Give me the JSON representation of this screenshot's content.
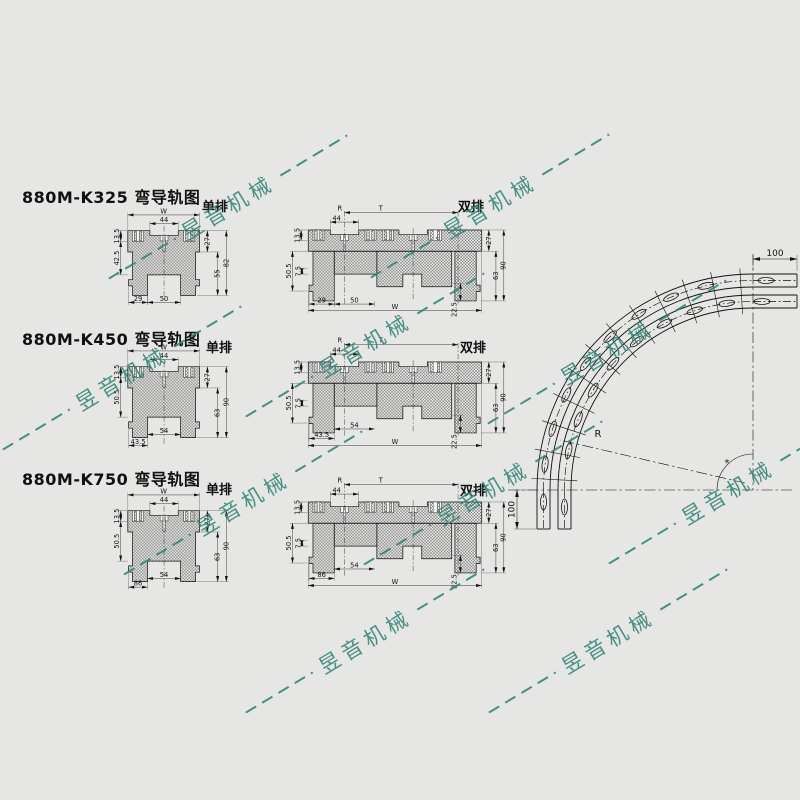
{
  "page": {
    "background": "#e6e6e4",
    "line_color": "#111111"
  },
  "watermark": {
    "text": "昱音机械",
    "color": "#2f8577"
  },
  "sections": [
    {
      "title": "880M-K325 弯导轨图",
      "single_label": "单排",
      "double_label": "双排",
      "single": {
        "w": "W",
        "n44": "44",
        "h135": "13.5",
        "left": "42.5",
        "r1": "27",
        "r2": "55",
        "r3": "82",
        "b1": "29",
        "b2": "50"
      },
      "double": {
        "n44": "44",
        "r": "R",
        "t": "T",
        "h135": "13.5",
        "l1": "50.5",
        "l2": "7.5",
        "r1": "27",
        "r2": "90",
        "r3": "63",
        "r4": "22.5",
        "b1": "29",
        "b2": "50",
        "w": "W"
      }
    },
    {
      "title": "880M-K450 弯导轨图",
      "single_label": "单排",
      "double_label": "双排",
      "single": {
        "w": "W",
        "n44": "44",
        "h135": "13.5",
        "left": "50.5",
        "r1": "27",
        "r2": "63",
        "r3": "90",
        "b1": "43.5",
        "b2": "54"
      },
      "double": {
        "n44": "44",
        "r": "R",
        "t": "T",
        "h135": "13.5",
        "l1": "50.5",
        "l2": "7.5",
        "r1": "27",
        "r2": "90",
        "r3": "63",
        "r4": "22.5",
        "b1": "43.5",
        "b2": "54",
        "w": "W"
      }
    },
    {
      "title": "880M-K750 弯导轨图",
      "single_label": "单排",
      "double_label": "双排",
      "single": {
        "w": "W",
        "n44": "44",
        "h135": "13.5",
        "left": "50.5",
        "r1": "27",
        "r2": "63",
        "r3": "90",
        "b1": "86",
        "b2": "54"
      },
      "double": {
        "n44": "44",
        "r": "R",
        "t": "T",
        "h135": "13.5",
        "l1": "50.5",
        "l2": "7.5",
        "r1": "27",
        "r2": "90",
        "r3": "63",
        "r4": "22.5",
        "b1": "86",
        "b2": "54",
        "w": "W"
      }
    }
  ],
  "curve": {
    "dim_top": "100",
    "dim_left": "100",
    "radius_label": "R",
    "angle_mark": "*"
  }
}
